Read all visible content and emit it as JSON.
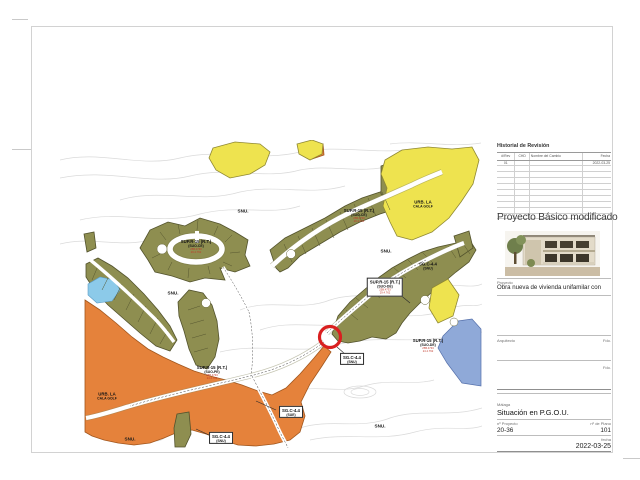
{
  "title_block": {
    "revision": {
      "title": "Historial de Revisión",
      "columns": [
        "#/Rev",
        "CHD",
        "Nombre del Cambio",
        "Fecha"
      ],
      "first_row": {
        "rev": "01",
        "chd": "",
        "name": "",
        "date": "2022-03-25"
      },
      "empty_rows": 9
    },
    "project_type": "Proyecto Básico modificado",
    "project_label": "Proyecto",
    "project_description": "Obra nueva de vivienda unifamilar con",
    "architect_label": "Arquitecto",
    "signed_label": "Fdo.",
    "signed_label_2": "Fdo.",
    "municipality": "Málaga",
    "sheet_name": "Situación en P.G.O.U.",
    "project_no_label": "nº Proyecto",
    "project_no": "20-36",
    "plan_no_label": "nº de Plano",
    "plan_no": "101",
    "date_label": "fecha",
    "date": "2022-03-25"
  },
  "map": {
    "snu_text": "SNU.",
    "marker_color": "#d91f1f",
    "zone_colors": {
      "olive_suo": "#8e8e50",
      "orange_suo_pe": "#e5823b",
      "yellow_urbanized": "#eee34f",
      "blue_zone": "#8fa9d8",
      "water": "#8ccae9"
    },
    "zone_labels": [
      {
        "text": "SUP.R-15 (R.T.)",
        "sub": "(SUO-CE)",
        "red": [
          "25B.4730",
          "29.4.762"
        ],
        "x": 136,
        "y": 107,
        "boxed": false
      },
      {
        "text": "SUP.R-15 (R.T.)",
        "sub": "(SUO-CE)",
        "red": [
          "25B.4730",
          "29.4.762"
        ],
        "x": 299,
        "y": 76,
        "boxed": false
      },
      {
        "text": "URB. LA",
        "sub": "CALA GOLF",
        "red": [],
        "x": 363,
        "y": 64,
        "boxed": false
      },
      {
        "text": "SG.C-4.4",
        "sub": "(SNU)",
        "red": [],
        "x": 368,
        "y": 126,
        "boxed": false
      },
      {
        "text": "SUP.R-15 (R.T.)",
        "sub": "(SUO-DE)",
        "red": [
          "25B.4733",
          "29.4.762"
        ],
        "x": 325,
        "y": 147,
        "boxed": true
      },
      {
        "text": "SUP.R-15 (R.T.)",
        "sub": "(SUO-DE)",
        "red": [
          "25B.4733",
          "24.4.762"
        ],
        "x": 368,
        "y": 206,
        "boxed": false
      },
      {
        "text": "SUP.R-15 (R.T.)",
        "sub": "(SUO-PE)",
        "red": [
          "25B.4733",
          "24.4.762"
        ],
        "x": 152,
        "y": 233,
        "boxed": false
      },
      {
        "text": "URB. LA",
        "sub": "CALA GOLF",
        "red": [],
        "x": 47,
        "y": 256,
        "boxed": false
      },
      {
        "text": "SG.C-4.4",
        "sub": "(SNU)",
        "red": [],
        "x": 292,
        "y": 219,
        "boxed": true
      },
      {
        "text": "SG.C-4.4",
        "sub": "(SUE)",
        "red": [],
        "x": 231,
        "y": 272,
        "boxed": true
      },
      {
        "text": "SG.C-4.4",
        "sub": "(SNU)",
        "red": [],
        "x": 161,
        "y": 298,
        "boxed": true
      }
    ],
    "snu_labels": [
      {
        "x": 183,
        "y": 71
      },
      {
        "x": 113,
        "y": 153
      },
      {
        "x": 326,
        "y": 111
      },
      {
        "x": 70,
        "y": 299
      },
      {
        "x": 320,
        "y": 286
      }
    ]
  }
}
